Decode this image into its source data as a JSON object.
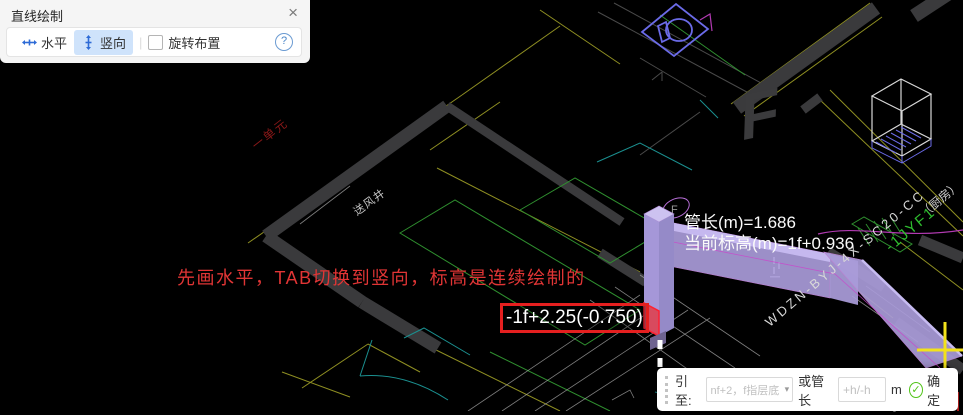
{
  "draw_panel": {
    "title": "直线绘制",
    "close": "×",
    "horizontal_label": "水平",
    "vertical_label": "竖向",
    "rotate_checkbox_label": "旋转布置",
    "help": "?"
  },
  "canvas": {
    "tip_text": "先画水平，TAB切换到竖向，标高是连续绘制的",
    "elevation_tag": "-1f+2.25(-0.750)",
    "pipe_length_text": "管长(m)=1.686",
    "current_elevation_text": "当前标高(m)=1f+0.936",
    "cad_labels": {
      "unit": "一单元",
      "air_shaft": "送风井",
      "cable_code": "WDZN-BYJ-4X-SC20-CC",
      "room": "（厨房）",
      "riser": "-1JYF1",
      "duct_size": "300x300",
      "big_letter": "F",
      "circle_letter": "F"
    }
  },
  "input_bar": {
    "lead_label": "引至:",
    "target_placeholder": "nf+2，f指层底",
    "caret": "▾",
    "or_label": "或管长",
    "length_placeholder": "+h/-h",
    "unit": "m",
    "confirm_label": "确定"
  }
}
